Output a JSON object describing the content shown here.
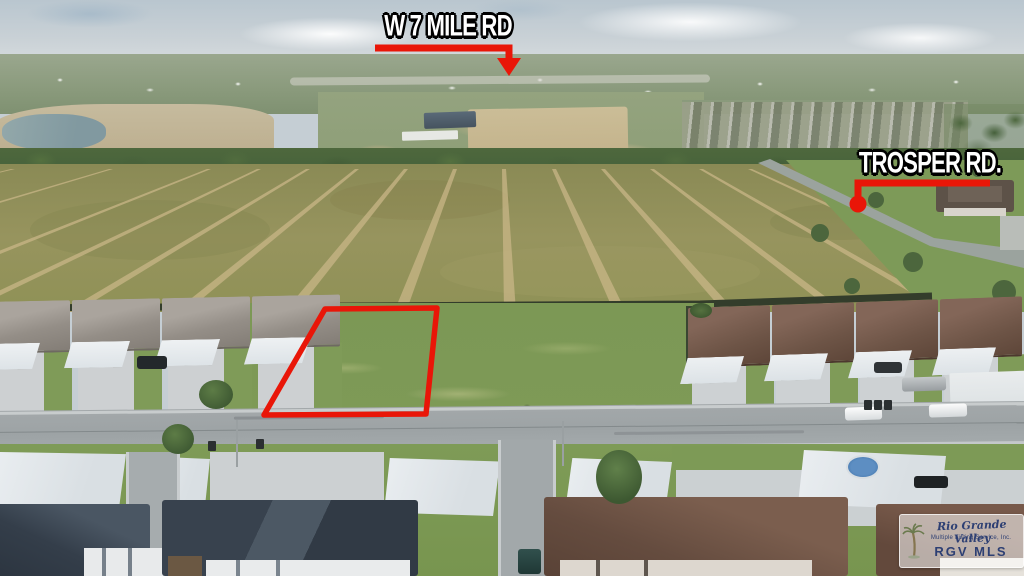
{
  "annotations": {
    "top_road": {
      "label": "W 7 MILE RD"
    },
    "right_road": {
      "label": "TROSPER RD."
    },
    "marker_color": "#e91608",
    "label_text_color": "#ffffff",
    "label_outline_color": "#000000"
  },
  "parcel_outline": {
    "color": "#e91608"
  },
  "watermark": {
    "brand_script": "Rio Grande Valley",
    "brand_sub": "Multiple Listing Service, Inc.",
    "brand_abbr": "RGV MLS",
    "text_color": "#2d3f73"
  }
}
